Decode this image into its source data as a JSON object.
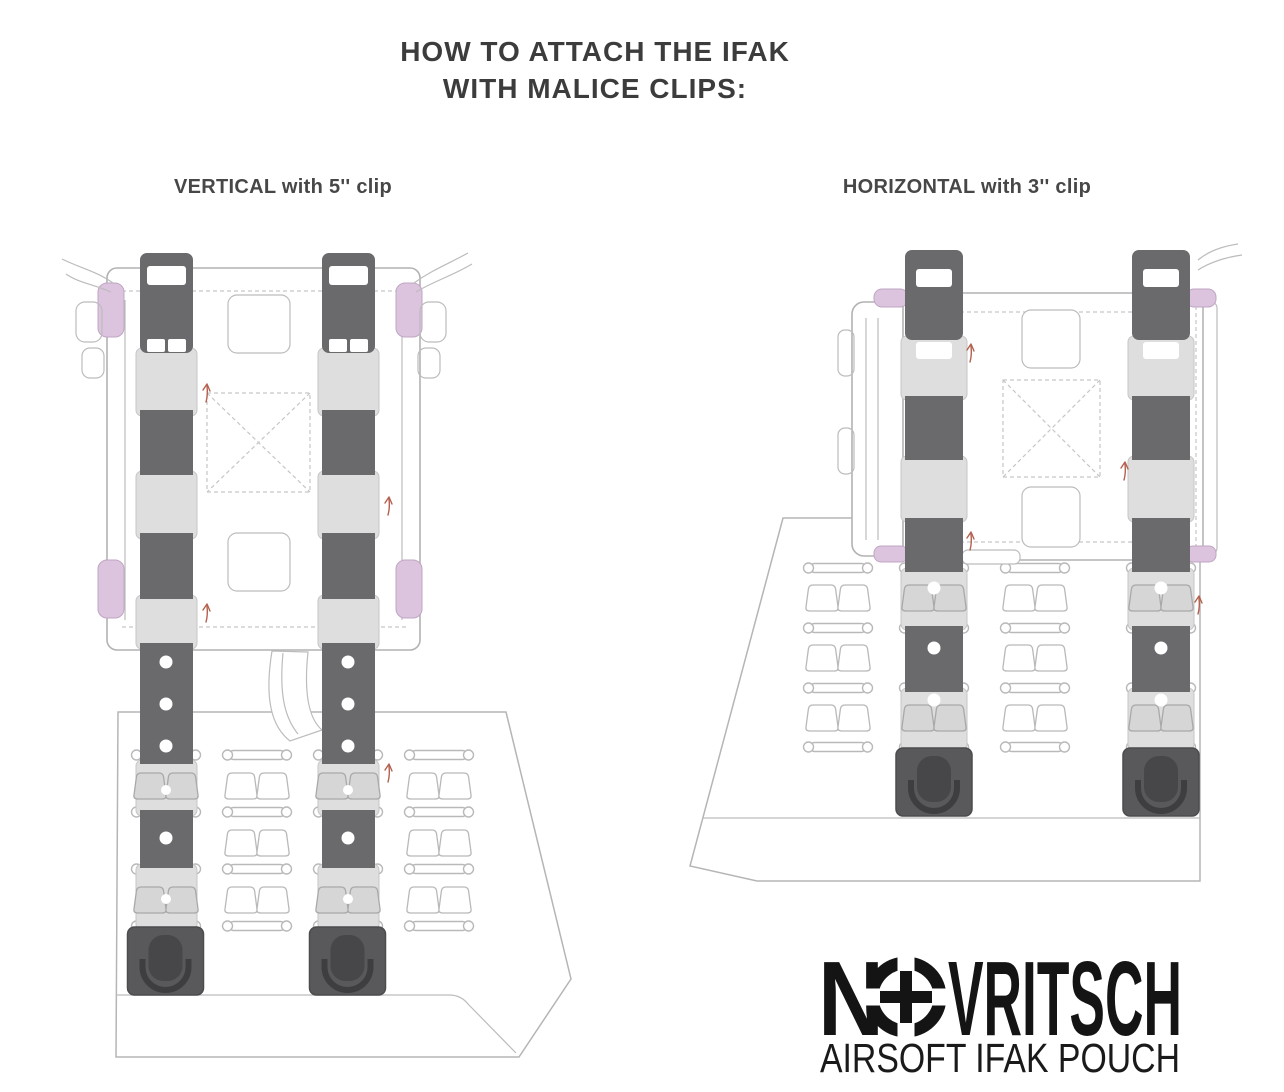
{
  "page": {
    "background": "#ffffff"
  },
  "title": {
    "line1": "HOW TO ATTACH THE IFAK",
    "line2": "WITH MALICE CLIPS:"
  },
  "diagrams": {
    "vertical": {
      "label": "VERTICAL with 5'' clip",
      "orientation": "VERTICAL",
      "clip_size": "5''",
      "clip_count": 2
    },
    "horizontal": {
      "label": "HORIZONTAL with 3'' clip",
      "orientation": "HORIZONTAL",
      "clip_size": "3''",
      "clip_count": 2
    }
  },
  "logo": {
    "brand_prefix": "N",
    "brand_suffix": "VRITSCH",
    "brand_full": "NOVRITSCH",
    "o_icon": "scope-reticle-icon",
    "subtitle": "AIRSOFT IFAK POUCH"
  },
  "colors": {
    "background": "#ffffff",
    "strap_dark": "#6a6a6d",
    "strap_light": "#dedede",
    "clip_block": "#59595c",
    "clip_tab": "#47474a",
    "outline_gray": "#b5b5b5",
    "pink_elastic": "#dcc3de",
    "title_text": "#3c3c3c",
    "label_text": "#474747",
    "logo_black": "#141414",
    "stitch_arrow": "#b4604f"
  }
}
